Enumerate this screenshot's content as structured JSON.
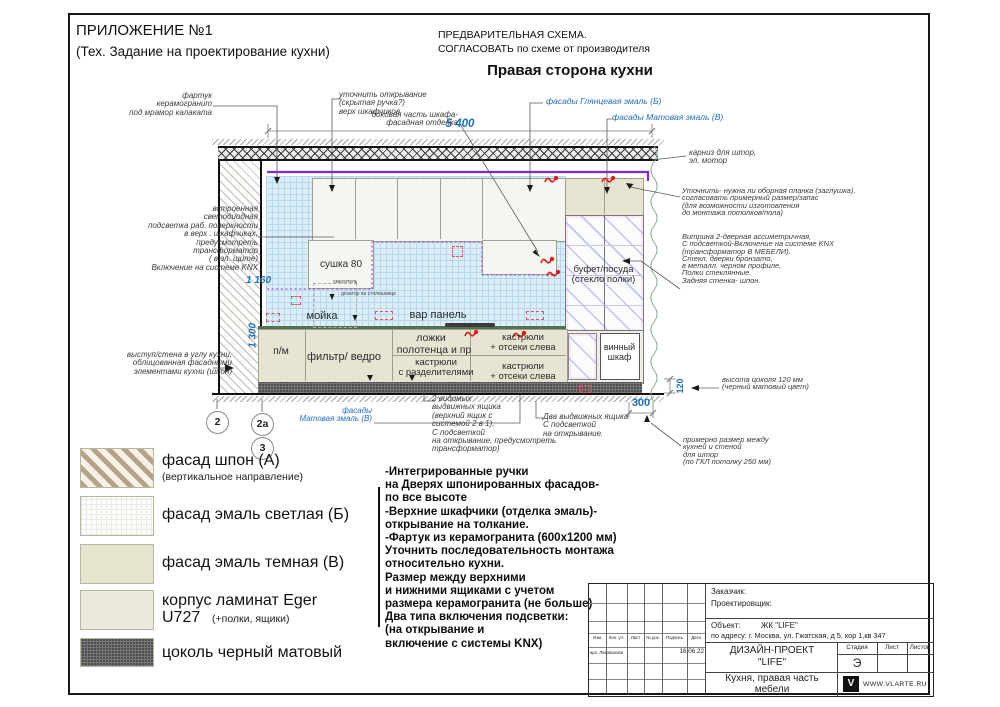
{
  "header": {
    "appendix": "ПРИЛОЖЕНИЕ №1",
    "appendix_sub": "(Тех. Задание на проектирование кухни)",
    "prelim1": "ПРЕДВАРИТЕЛЬНАЯ СХЕМА.",
    "prelim2": "СОГЛАСОВАТЬ по схеме от производителя",
    "side_title": "Правая сторона кухни"
  },
  "colors": {
    "accent_blue": "#1f6fbe",
    "cornice_purple": "#7a2bd6",
    "led_purple": "#a757d8",
    "marker_red": "#e01b1b"
  },
  "ann": {
    "fartuk": "фартук\nкерамогранит\nпод мрамор калаката",
    "opening": "уточнить открывание\n(скрытая ручка?)\nверх шкафчиков",
    "side": "боковая часть  шкафа-\nфасадная отделка",
    "gloss": "фасады Глянцевая  эмаль (Б)",
    "matte_top": "фасады Матовая эмаль (В)",
    "cornice": "карниз для штор,\nэл. мотор",
    "planka": "Уточнить- нужна ли оборная планка (заглушка),\nсогласовать примерный размер/запас\n(для возможности изготовления\nдо монтажа потолков/пола)",
    "vitrine": "Витрина 2-дверная ассиметричная,\nС подсветкой-Включение на системе KNX\n(трансформатор В МЕБЕЛИ).\nСтекл. дверки  бронзато,\nв металл. черном профиле,\nПолки стеклянные.\nЗадняя стенка- шпон.",
    "led": "встроенная\nсветодиодная\nподсветка раб. поверхности\nв верх . шкафчиках,\nпредусмотреть\nтрансформатор\n( в эл.  щите)\nВключение на системе KNX",
    "ledge": "выступ/стена в углу кухни,\nоблицованная фасадными\nэлементами кухни (шпон)",
    "drawers2": "2 видимых\nвыдвижных ящика\n(верхний ящик с\nсистемой  2 в 1),\n С подсветкой\nна открывание, предусмотреть\nтрансформатор)",
    "matte_bottom": "фасады\nМатовая эмаль (В)",
    "drawers_two": "Два выдвижных ящика\nС подсветкой\nна открывание.",
    "curtain": "примерно размер между\nкухней и стеной\n для штор\n(по ГКЛ потолку 250 мм)",
    "plinth_h": "высота цоколя 120 мм\n(черный матовый цвет)"
  },
  "dims": {
    "total": "5 400",
    "h1": "1 160",
    "h2": "1 300",
    "gap": "300",
    "plinth": "120"
  },
  "labels": {
    "sushka": "сушка 80",
    "mixer": "смеситель",
    "dispenser": "дозатор на столешнице",
    "sink": "мойка",
    "hob": "вар панель",
    "pm": "п/м",
    "filter": "фильтр/ ведро",
    "spoons": "ложки",
    "towels": "полотенца и пр",
    "pots_left": "кастрюли\n+ отсеки слева",
    "pots_div": "кастрюли\nс разделителями",
    "pots_left2": "кастрюли\n+ отсеки слева",
    "buffet": "буфет/посуда\n(стекло полки)",
    "wine": "винный\nшкаф"
  },
  "markers": {
    "m2": "2",
    "m2a": "2a",
    "m3": "3"
  },
  "legend": {
    "items": [
      {
        "label": "фасад шпон (А)",
        "sub": "(вертикальное направление)"
      },
      {
        "label": "фасад эмаль светлая (Б)",
        "sub": ""
      },
      {
        "label": "фасад эмаль темная (В)",
        "sub": ""
      },
      {
        "label": "корпус ламинат Eger\nU727",
        "sub": "(+полки, ящики)"
      },
      {
        "label": "цоколь черный матовый",
        "sub": ""
      }
    ]
  },
  "notes": "-Интегрированные ручки\nна Дверях шпонированных фасадов-\nпо все высоте\n-Верхние шкафчики (отделка эмаль)-\nоткрывание на толкание.\n-Фартук из керамогранита (600x1200 мм)\nУточнить последовательность монтажа\nотносительно кухни.\nРазмер между верхними\nи нижними ящиками с учетом\nразмера керамогранита (не больше)\nДва типа включения подсветки:\n(на открывание и\nвключение с  системы KNX)",
  "titleblock": {
    "customer": "Заказчик:",
    "designer": "Проектировщик:",
    "object_label": "Объект:",
    "object_value": "ЖК  \"LIFE\"",
    "address": "по адресу: г. Москва, ул. Гжатская, д 5, кор 1,кв 347",
    "cols": [
      "Изм.",
      "Кол. уч.",
      "Лист",
      "№ док.",
      "Подпись",
      "Дата"
    ],
    "author": "арх. Лихованова",
    "date": "16.06.22",
    "project": "ДИЗАЙН-ПРОЕКТ\n\"LIFE\"",
    "stage_label": "Стадия",
    "sheet_label": "Лист",
    "sheets_label": "Листов",
    "stage": "Э",
    "subtitle": "Кухня, правая часть\nмебели",
    "site": "WWW.VLARTE.RU",
    "logo": "V"
  }
}
